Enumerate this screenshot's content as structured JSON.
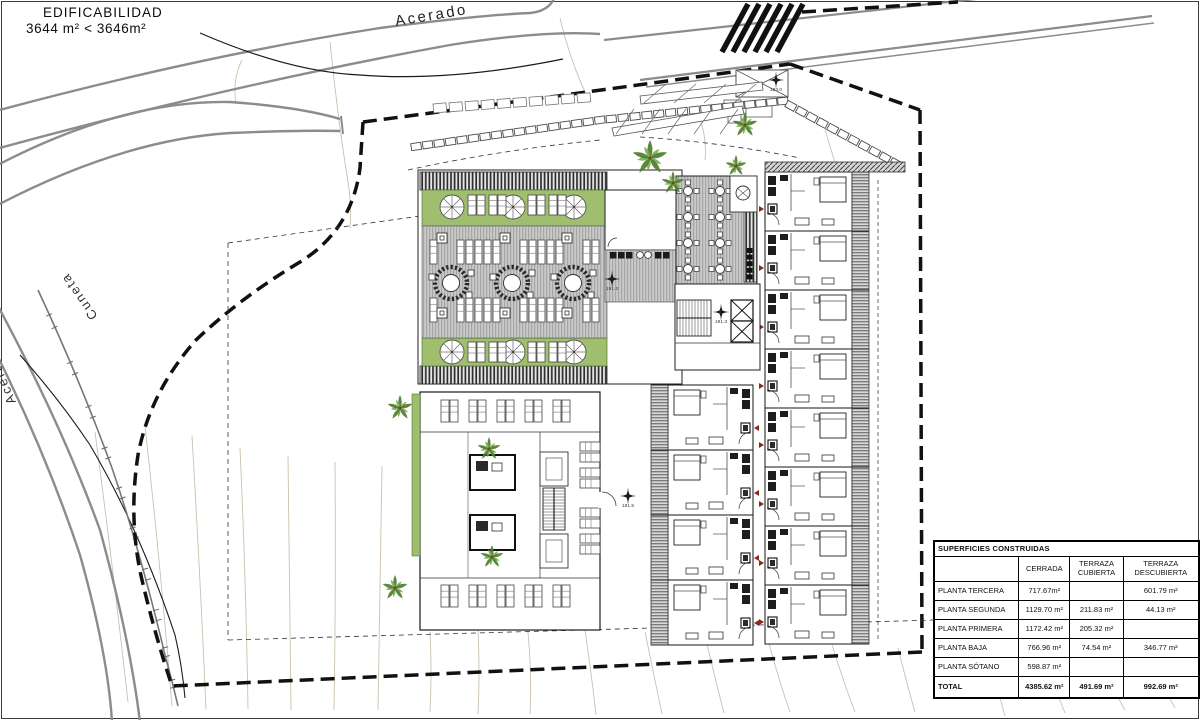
{
  "title_block": {
    "line1": "EDIFICABILIDAD",
    "line2": "3644 m²  <  3646m²"
  },
  "road_labels": {
    "top": "Acerado",
    "left_inner": "Cuneta",
    "left_outer": "Acerado"
  },
  "elevation_markers": {
    "street": "183.0",
    "roof_deck": "191.3",
    "core": "191.3",
    "pool_terrace": "181.5"
  },
  "surfaces_table": {
    "title": "SUPERFICIES CONSTRUIDAS",
    "columns": [
      "",
      "CERRADA",
      "TERRAZA\nCUBIERTA",
      "TERRAZA\nDESCUBIERTA"
    ],
    "rows": [
      {
        "label": "PLANTA TERCERA",
        "cerrada": "717.67m²",
        "terraza_cubierta": "",
        "terraza_descubierta": "601.79 m²"
      },
      {
        "label": "PLANTA SEGUNDA",
        "cerrada": "1129.70 m²",
        "terraza_cubierta": "211.83 m²",
        "terraza_descubierta": "44.13 m²"
      },
      {
        "label": "PLANTA PRIMERA",
        "cerrada": "1172.42 m²",
        "terraza_cubierta": "205.32 m²",
        "terraza_descubierta": ""
      },
      {
        "label": "PLANTA BAJA",
        "cerrada": "766.96 m²",
        "terraza_cubierta": "74.54 m²",
        "terraza_descubierta": "346.77 m²"
      },
      {
        "label": "PLANTA SÓTANO",
        "cerrada": "598.87 m²",
        "terraza_cubierta": "",
        "terraza_descubierta": ""
      }
    ],
    "total_row": {
      "label": "TOTAL",
      "cerrada": "4385.62 m²",
      "terraza_cubierta": "491.69 m²",
      "terraza_descubierta": "992.69 m²"
    }
  },
  "colors": {
    "lawn_green": "#9fbf6f",
    "palm_dark": "#4e7f2f",
    "palm_light": "#7fae4f",
    "contour": "#cdc0ad",
    "road_gray": "#8c8c8c",
    "boundary_black": "#111111",
    "door_arrow_red": "#8a2a1e",
    "deck_gray": "#c9c9c9"
  }
}
